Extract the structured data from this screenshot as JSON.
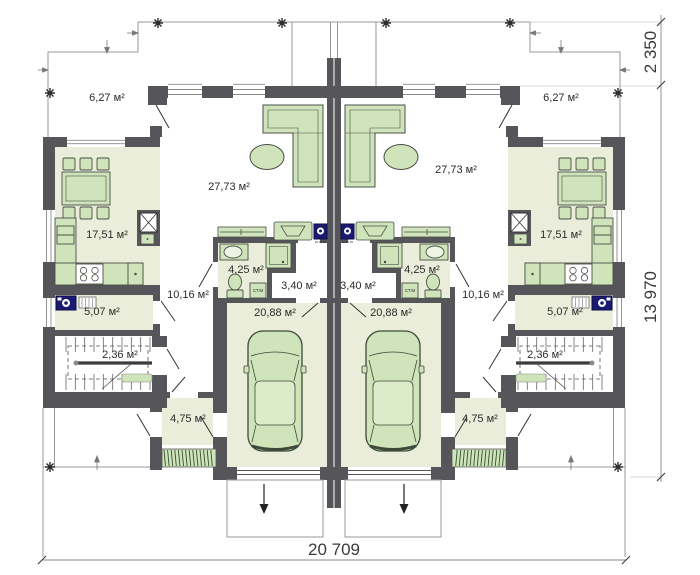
{
  "rooms": {
    "terrace": "6,27 м²",
    "living": "27,73 м²",
    "kitchen": "17,51 м²",
    "bathroom": "4,25 м²",
    "hall": "3,40 м²",
    "corridor": "10,16 м²",
    "hallway": "5,07 м²",
    "stairs": "2,36 м²",
    "garage": "20,88 м²",
    "vestibule": "4,75 м²"
  },
  "dimensions": {
    "overall_width": "20 709",
    "building_depth": "13 970",
    "terrace_depth": "2 350"
  },
  "appliances": {
    "washing_machine": "СТ.М"
  },
  "colors": {
    "wall": "#56565a",
    "floor": "#e9edd9",
    "furniture": "#cfe4ba",
    "appliance_blue": "#1a1a72",
    "outline": "#999999"
  }
}
